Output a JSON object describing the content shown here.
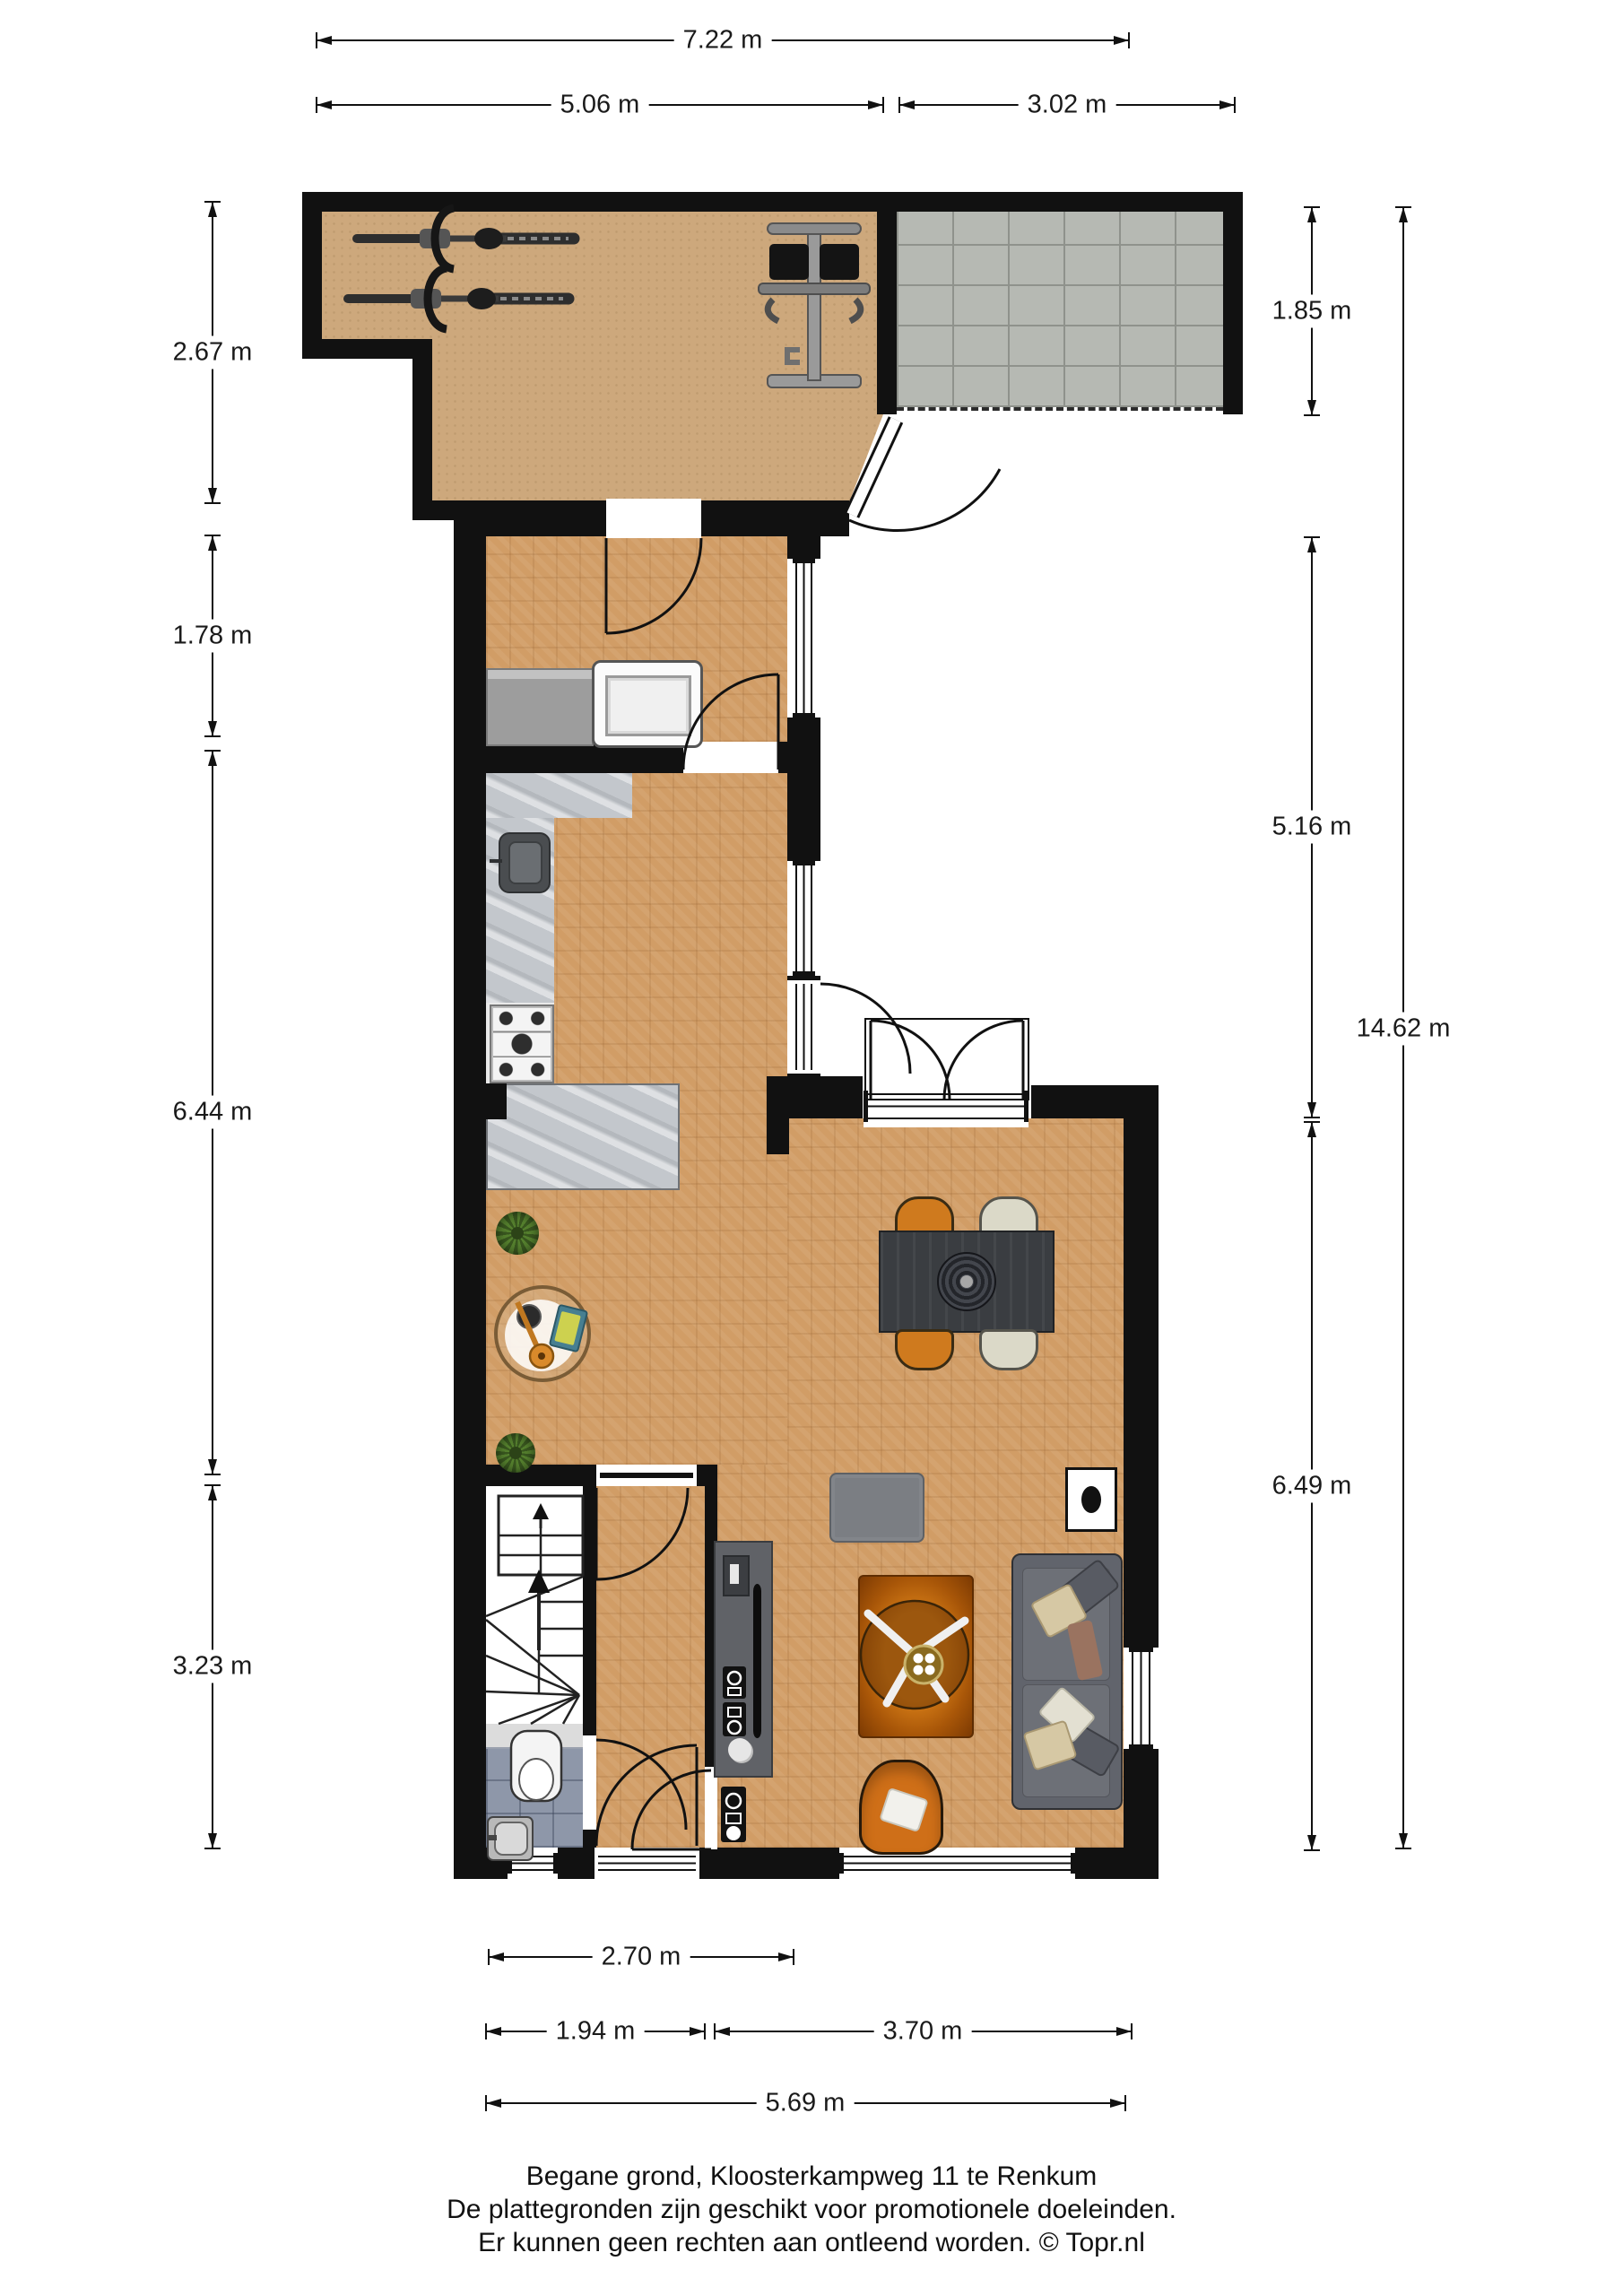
{
  "dims": {
    "top_total": "7.22 m",
    "top_left": "5.06 m",
    "top_right": "3.02 m",
    "left_garage": "2.67 m",
    "left_utility": "1.78 m",
    "left_kitchen": "6.44 m",
    "left_stairs": "3.23 m",
    "right_patio": "1.85 m",
    "right_upper": "5.16 m",
    "right_lower": "6.49 m",
    "right_total": "14.62 m",
    "bottom_hall": "2.70 m",
    "bottom_left": "1.94 m",
    "bottom_right": "3.70 m",
    "bottom_total": "5.69 m"
  },
  "footer": {
    "line1": "Begane grond, Kloosterkampweg 11 te Renkum",
    "line2": "De plattegronden zijn geschikt voor promotionele doeleinden.",
    "line3": "Er kunnen geen rechten aan ontleend worden. © Topr.nl"
  },
  "colors": {
    "wall": "#111111",
    "garage_floor": "#cda87c",
    "parquet": "#d19d66",
    "patio_tile": "#b6b9b3",
    "counter": "#c3c7cc",
    "toilet_tile": "#8e97a9",
    "sofa_gray": "#61646c",
    "accent_orange": "#cf7a1e",
    "chair_cream": "#dbd9c8",
    "table_dark": "#3a3d41"
  },
  "icons": [
    "bicycle-icon",
    "home-gym-icon",
    "washing-machine-icon",
    "fridge-icon",
    "sink-icon",
    "stove-icon",
    "toilet-icon",
    "hand-basin-icon",
    "stairs-icon",
    "sofa-icon",
    "armchair-icon",
    "tv-cabinet-icon",
    "dining-table-icon",
    "coffee-table-icon",
    "side-table-icon",
    "plant-icon",
    "rug-icon",
    "pouf-icon",
    "fireplace-icon",
    "meter-cabinet-icon"
  ]
}
